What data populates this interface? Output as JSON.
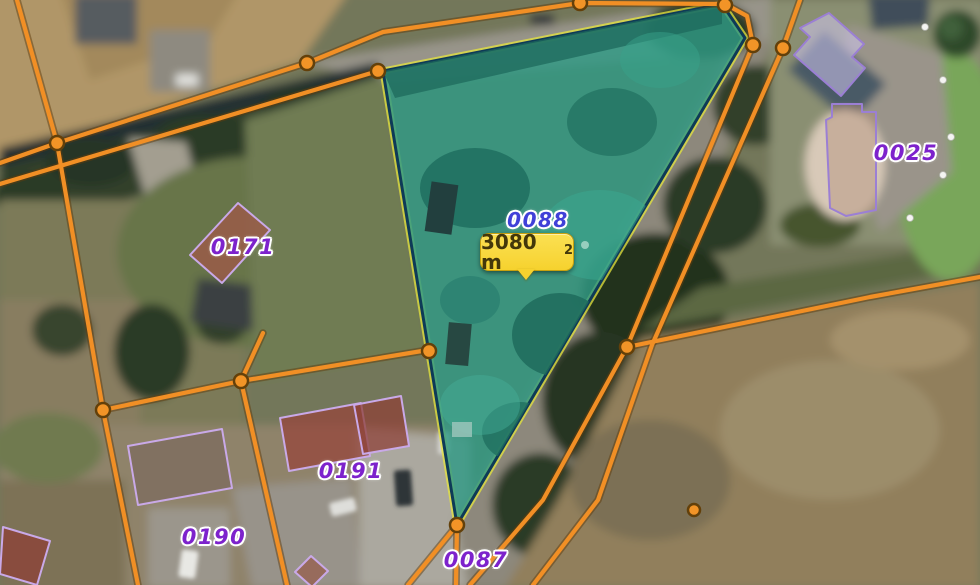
{
  "map": {
    "type": "cadastral-aerial-view",
    "selected_parcel": {
      "id": "0088",
      "area_full": "3080 m²",
      "area_value": "3080 m",
      "area_sup": "2"
    },
    "parcels": [
      {
        "label": "0088",
        "selected": true
      },
      {
        "label": "0171",
        "selected": false
      },
      {
        "label": "0025",
        "selected": false
      },
      {
        "label": "0191",
        "selected": false
      },
      {
        "label": "0190",
        "selected": false
      },
      {
        "label": "0087",
        "selected": false
      }
    ],
    "colors": {
      "boundary_orange": "#f18f25",
      "boundary_vertex": "#f29427",
      "selection_fill_teal": "#2f9a85",
      "selection_border_navy": "#0e3a57",
      "selection_halo_yellow": "#e6e53e",
      "building_outline_purple": "#c9a9e8",
      "label_purple": "#7d22cc",
      "label_selected_blue": "#4040d8",
      "tooltip_yellow": "#f6d22e"
    },
    "markers": {
      "boundary_vertex_count": 13,
      "white_handle_count": 5
    }
  }
}
